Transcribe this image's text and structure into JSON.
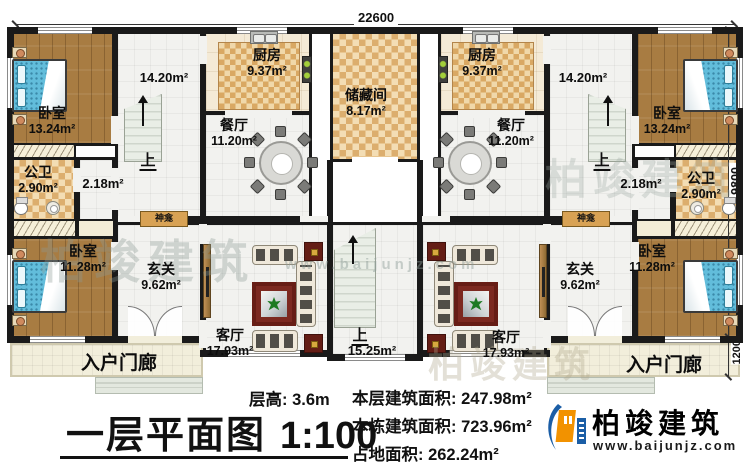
{
  "plan": {
    "dims": {
      "top": "22600",
      "right_main": "9800",
      "right_porch": "1200"
    },
    "center": {
      "storage_name": "储藏间",
      "storage_area": "8.17m²",
      "stairs_up": "上",
      "stairs_area": "15.25m²"
    },
    "left": {
      "bedroom_top_name": "卧室",
      "bedroom_top_area": "13.24m²",
      "bedroom_bottom_name": "卧室",
      "bedroom_bottom_area": "11.28m²",
      "kitchen_name": "厨房",
      "kitchen_area": "9.37m²",
      "dining_name": "餐厅",
      "dining_area": "11.20m²",
      "bath_name": "公卫",
      "bath_area": "2.90m²",
      "stairhall_area": "14.20m²",
      "stairs_up": "上",
      "corridor_area": "2.18m²",
      "foyer_name": "玄关",
      "foyer_area": "9.62m²",
      "living_name": "客厅",
      "living_area": "17.93m²",
      "porch_name": "入户门廊",
      "shrine": "神龛"
    },
    "right": {
      "bedroom_top_name": "卧室",
      "bedroom_top_area": "13.24m²",
      "bedroom_bottom_name": "卧室",
      "bedroom_bottom_area": "11.28m²",
      "kitchen_name": "厨房",
      "kitchen_area": "9.37m²",
      "dining_name": "餐厅",
      "dining_area": "11.20m²",
      "bath_name": "公卫",
      "bath_area": "2.90m²",
      "stairhall_area": "14.20m²",
      "stairs_up": "上",
      "corridor_area": "2.18m²",
      "foyer_name": "玄关",
      "foyer_area": "9.62m²",
      "living_name": "客厅",
      "living_area": "17.93m²",
      "porch_name": "入户门廊",
      "shrine": "神龛"
    }
  },
  "footer": {
    "title": "一层平面图",
    "scale": "1:100",
    "floor_height": "层高: 3.6m",
    "floor_area": "本层建筑面积: 247.98m²",
    "building_area": "本栋建筑面积: 723.96m²",
    "land_area": "占地面积: 262.24m²"
  },
  "brand": {
    "name": "柏竣建筑",
    "website": "www.baijunjz.com"
  },
  "colors": {
    "brand_blue": "#1b5ea6",
    "brand_orange": "#f29200",
    "wall": "#1a1a1a",
    "wood_floor": "#a87c42",
    "tile_dark": "#dcae6e",
    "tile_light": "#f3ddb4",
    "bed_blue": "#62bddb",
    "rug_red": "#7c2920"
  }
}
